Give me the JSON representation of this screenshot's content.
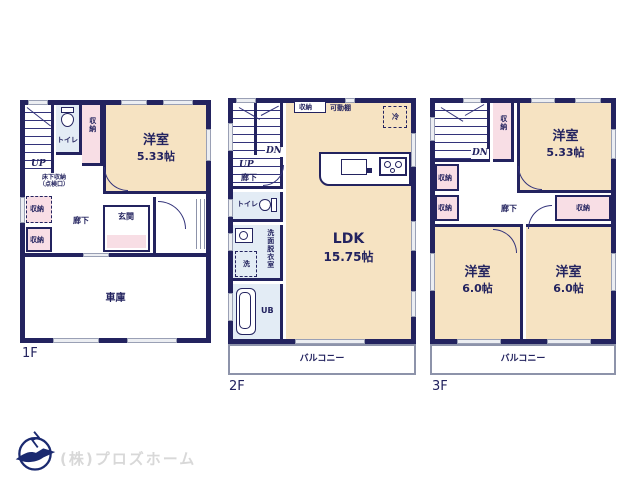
{
  "document": {
    "type": "floor-plan",
    "plans": [
      "1F",
      "2F",
      "3F"
    ]
  },
  "floors": {
    "f1": "1F",
    "f2": "2F",
    "f3": "3F"
  },
  "labels": {
    "up": "UP",
    "down": "DN",
    "western_room": "洋室",
    "toilet": "トイレ",
    "storage": "収納",
    "hallway": "廊下",
    "entrance": "玄関",
    "garage": "車庫",
    "underfloor_storage_line1": "床下収納",
    "underfloor_storage_line2": "（点検口）",
    "washroom": "洗面脱衣室",
    "washer": "洗",
    "unit_bath": "UB",
    "fridge": "冷",
    "movable_shelf": "可動棚",
    "ldk": "LDK",
    "balcony": "バルコニー"
  },
  "sizes": {
    "room_533": "5.33帖",
    "room_60": "6.0帖",
    "ldk_1575": "15.75帖"
  },
  "logo": {
    "company": "(株)プロズホーム"
  },
  "colors": {
    "wall": "#23235f",
    "room_beige": "#f6e3c2",
    "room_pink": "#f8dee5",
    "room_blue": "#e3ecf5",
    "logo_gray": "#d8d8d8"
  }
}
